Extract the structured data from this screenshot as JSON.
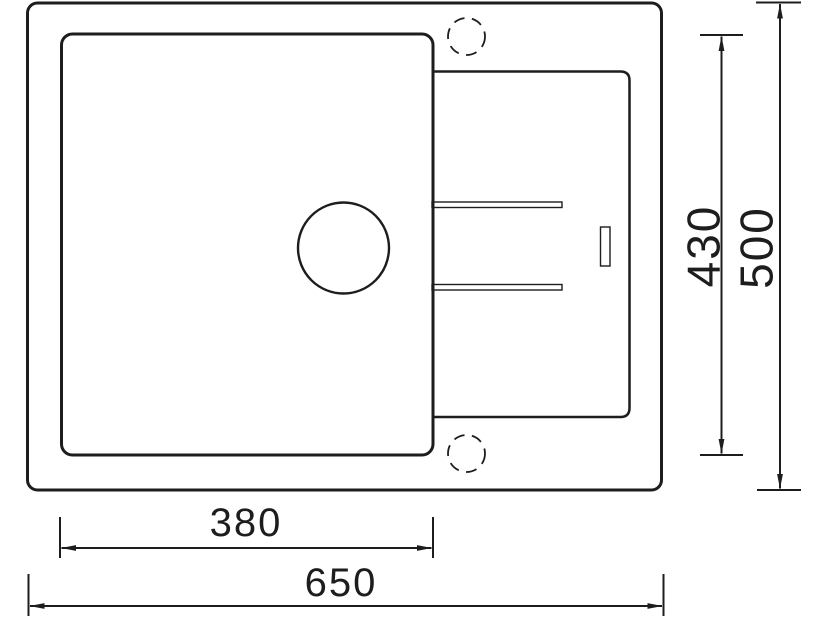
{
  "diagram": {
    "background_color": "#ffffff",
    "line_color": "#1d1d1d",
    "dimension_labels": {
      "basin_width": "380",
      "overall_width": "650",
      "basin_depth": "430",
      "overall_depth": "500"
    }
  }
}
